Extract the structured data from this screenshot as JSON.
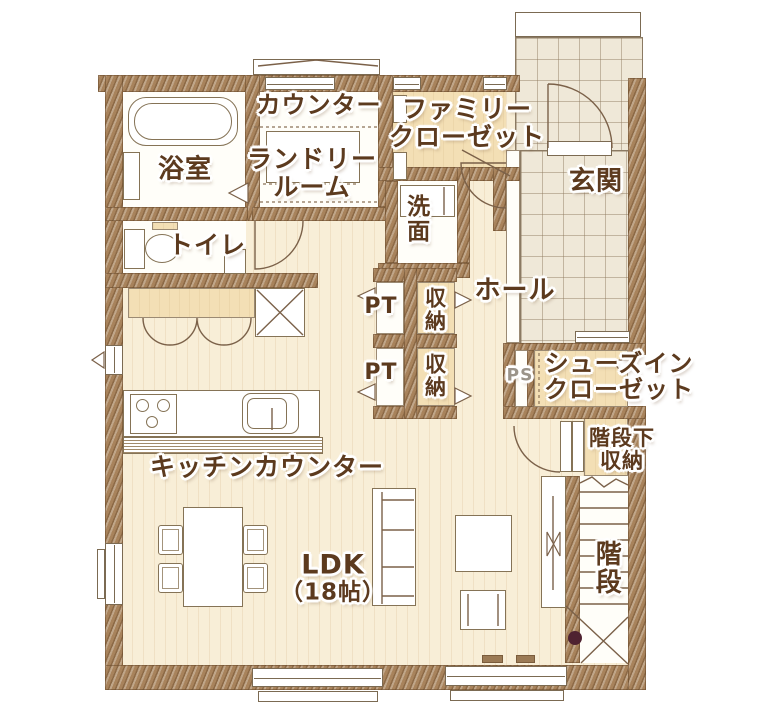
{
  "colors": {
    "wall": "#a8835c",
    "floor_wood": "#f8eed7",
    "floor_tan": "#f3dfb5",
    "floor_tile": "#efe8d8",
    "ink": "#5c3a1e",
    "ps_ink": "#9b948a",
    "stairs_dot": "#4f2231"
  },
  "labels": {
    "counter": "カウンター",
    "family_closet": [
      "ファミリー",
      "クローゼット"
    ],
    "bathroom": "浴室",
    "laundry_room": [
      "ランドリー",
      "ルーム"
    ],
    "washroom": "洗面",
    "entrance": "玄関",
    "toilet": "トイレ",
    "hall": "ホール",
    "pantry_upper": "PT",
    "pantry_lower": "PT",
    "storage_upper": "収納",
    "storage_lower": "収納",
    "pipe_space": "PS",
    "shoes_in_closet": [
      "シューズイン",
      "クローゼット"
    ],
    "under_stairs_storage": [
      "階段下",
      "収納"
    ],
    "kitchen_counter": "キッチンカウンター",
    "ldk": [
      "LDK",
      "（18帖）"
    ],
    "stairs": "階段"
  }
}
